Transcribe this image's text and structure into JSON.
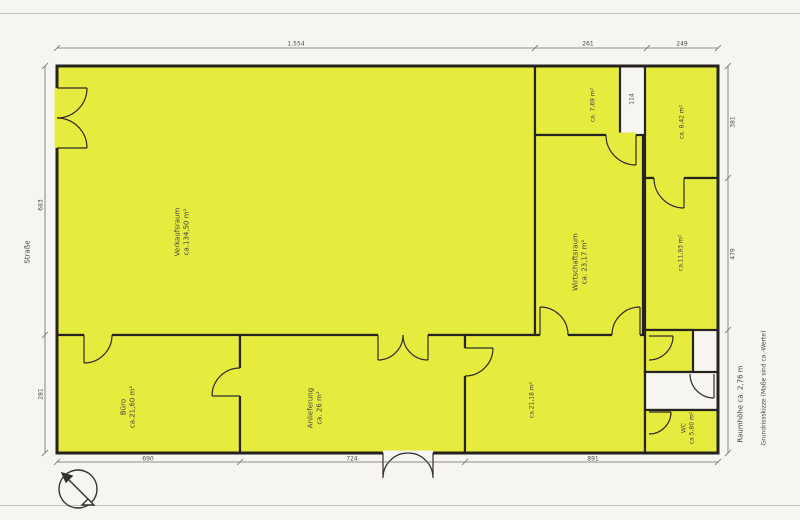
{
  "colors": {
    "room_fill": "#e6ec3e",
    "wall": "#26231c",
    "paper": "#f6f5f1",
    "text": "#3e3e4a"
  },
  "plan": {
    "rooms": [
      {
        "name": "Verkaufsraum",
        "area": "ca.134,50 m²"
      },
      {
        "name": "",
        "area": "ca. 7,69 m²"
      },
      {
        "name": "Wirtschaftsraum",
        "area": "ca. 23,17 m²"
      },
      {
        "name": "",
        "area": "ca. 8,42 m²"
      },
      {
        "name": "",
        "area": "ca.11,93 m²"
      },
      {
        "name": "Büro",
        "area": "ca.21,60 m²"
      },
      {
        "name": "Anlieferung",
        "area": "ca. 26 m²"
      },
      {
        "name": "",
        "area": "ca.21,18 m²"
      },
      {
        "name": "WC",
        "area": "ca 5,80 m²"
      }
    ],
    "margins": {
      "street": "Straße",
      "room_height": "Raumhöhe ca. 2,76 m",
      "note": "Grundrissskizze (Maße sind ca.-Werte)"
    },
    "dims": {
      "top": [
        "1.554",
        "261",
        "249"
      ],
      "left": [
        "683",
        "281"
      ],
      "bottom": [
        "690",
        "724",
        "891"
      ],
      "right": [
        "381",
        "479"
      ],
      "inner": [
        "114"
      ]
    }
  }
}
